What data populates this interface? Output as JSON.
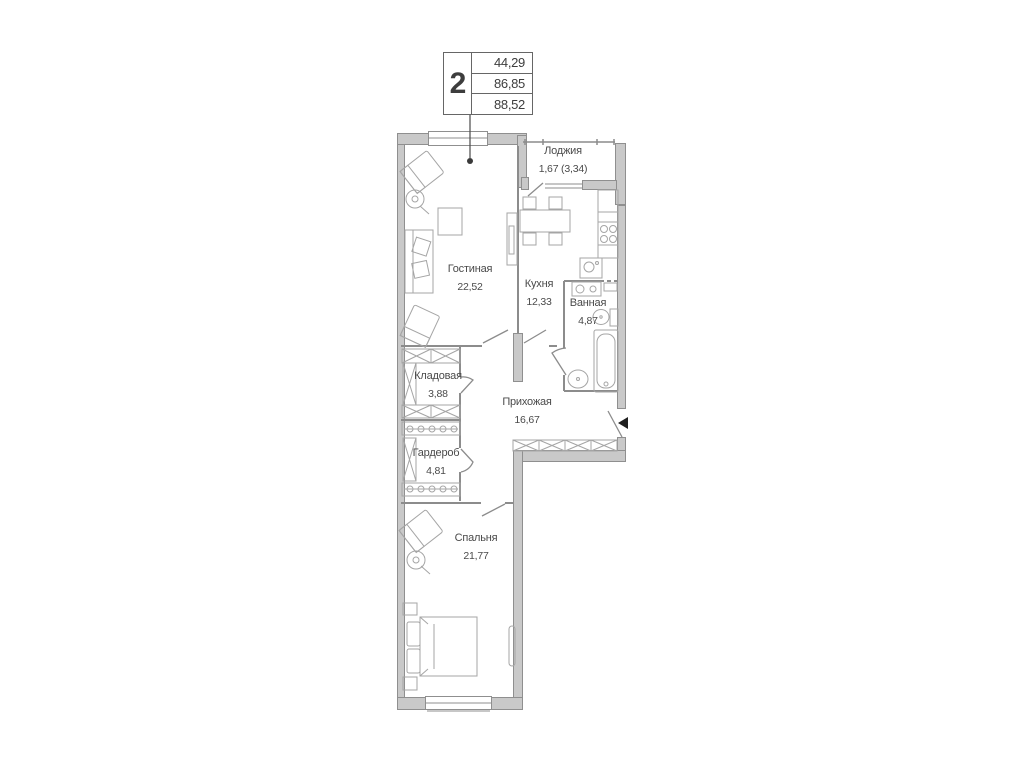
{
  "title_block": {
    "rooms_count": "2",
    "area_values": [
      "44,29",
      "86,85",
      "88,52"
    ]
  },
  "rooms": {
    "loggia": {
      "name": "Лоджия",
      "area": "1,67 (3,34)"
    },
    "living_room": {
      "name": "Гостиная",
      "area": "22,52"
    },
    "kitchen": {
      "name": "Кухня",
      "area": "12,33"
    },
    "bathroom": {
      "name": "Ванная",
      "area": "4,87"
    },
    "storage": {
      "name": "Кладовая",
      "area": "3,88"
    },
    "hallway": {
      "name": "Прихожая",
      "area": "16,67"
    },
    "wardrobe": {
      "name": "Гардероб",
      "area": "4,81"
    },
    "bedroom": {
      "name": "Спальня",
      "area": "21,77"
    }
  },
  "colors": {
    "wall_fill": "#c9c9c9",
    "wall_stroke": "#8f8f8f",
    "furniture_stroke": "#a5a5a5",
    "partition_stroke": "#8c8c8c",
    "text": "#4a4a4a",
    "background": "#ffffff",
    "entrance_marker": "#1f1f1f"
  }
}
